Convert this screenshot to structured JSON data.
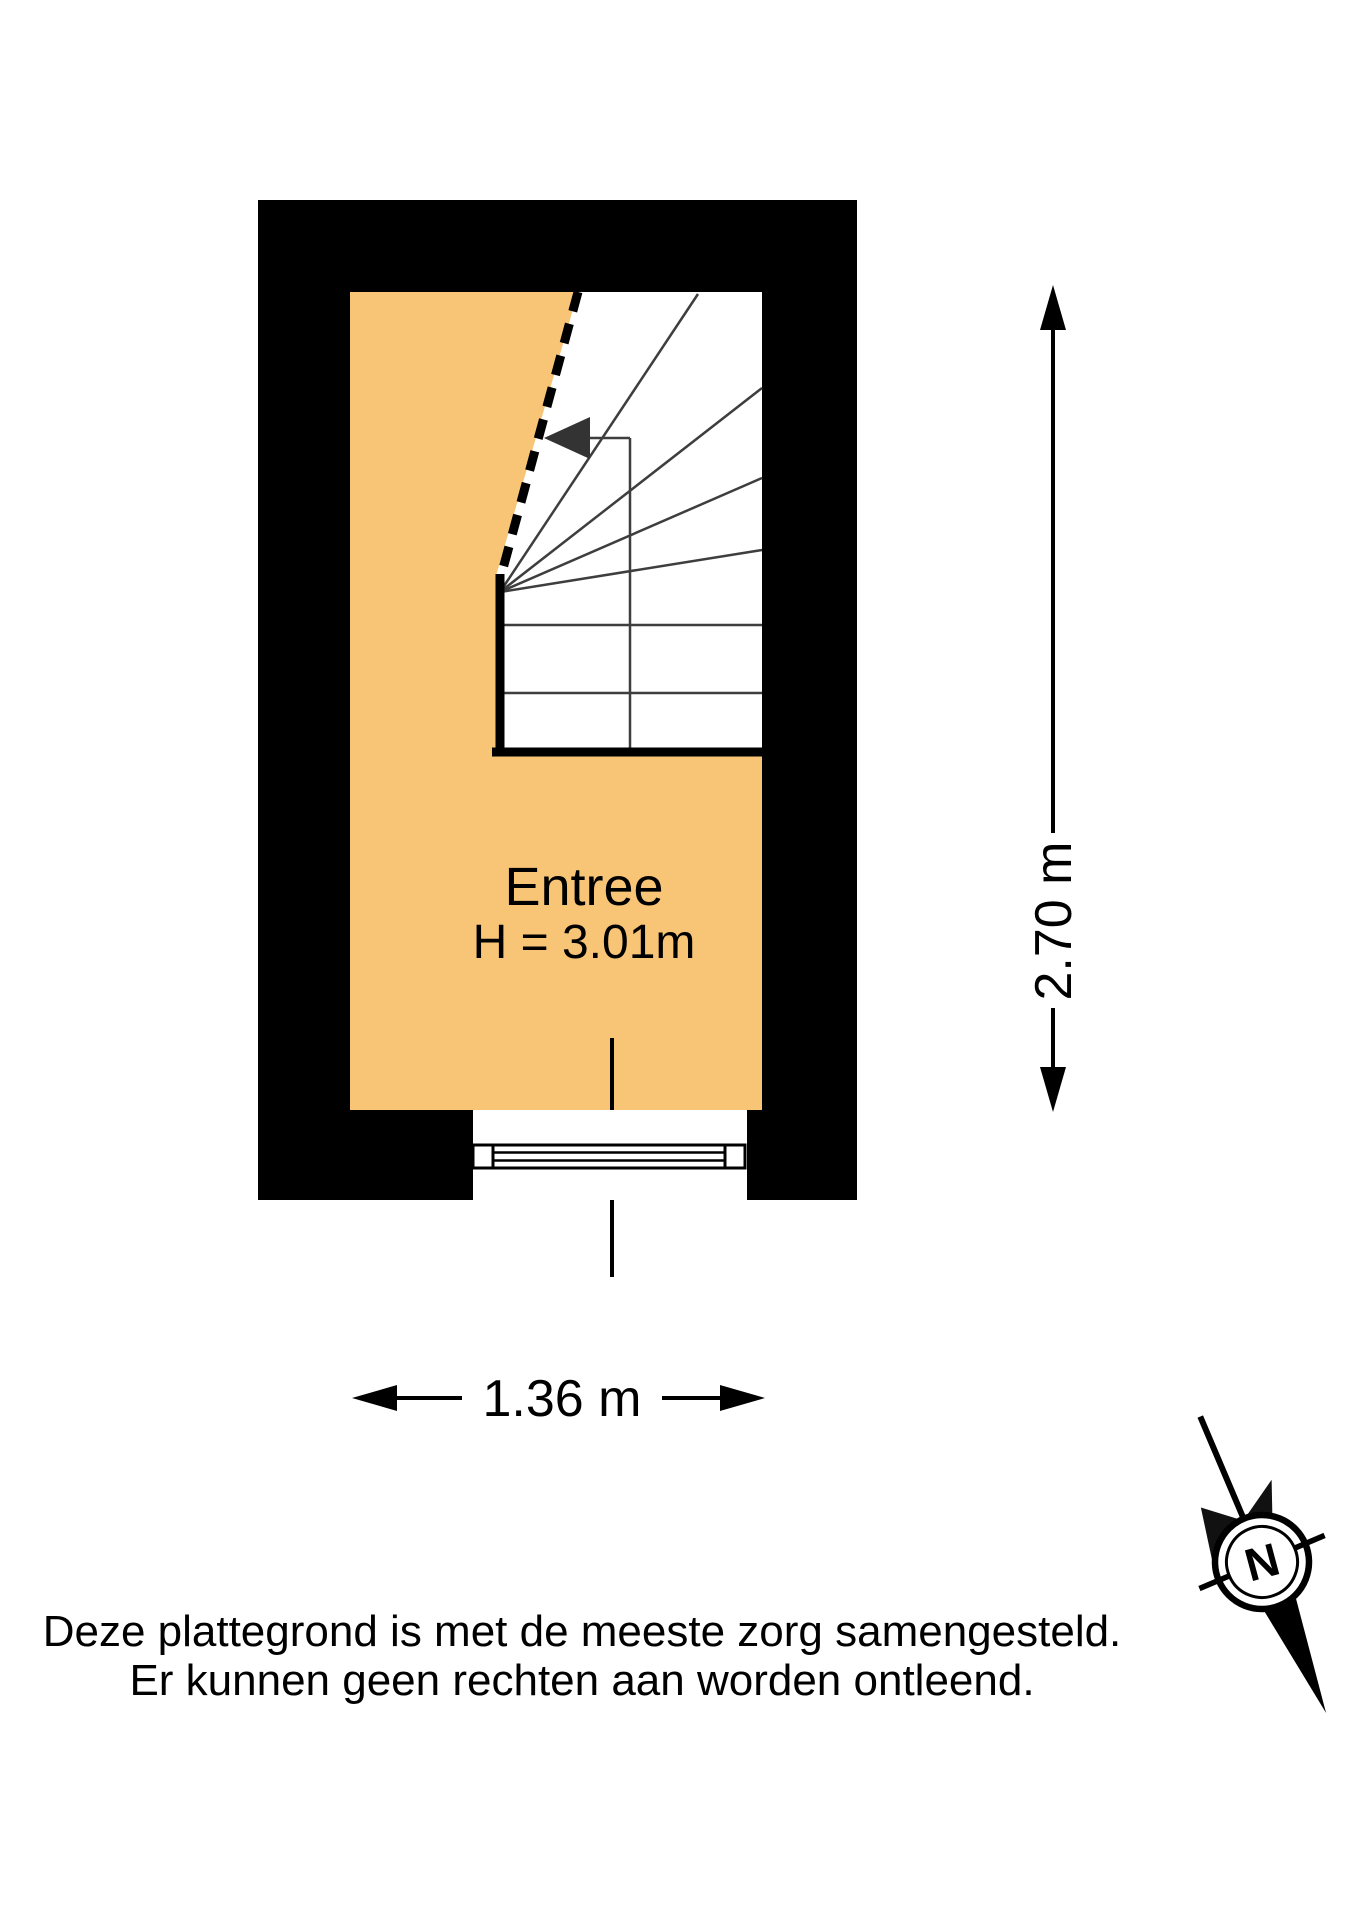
{
  "floor_plan": {
    "room": {
      "name": "Entree",
      "ceiling_height": "H = 3.01m"
    },
    "dimensions": {
      "width": "1.36 m",
      "height": "2.70 m"
    },
    "compass": {
      "north": "N"
    },
    "colors": {
      "wall": "#000000",
      "floor": "#F8C476",
      "stair_lines": "#3E3E3E",
      "background": "#FFFFFF"
    }
  },
  "disclaimer": {
    "line1": "Deze plattegrond is met de meeste zorg samengesteld.",
    "line2": "Er kunnen geen rechten aan worden ontleend."
  }
}
